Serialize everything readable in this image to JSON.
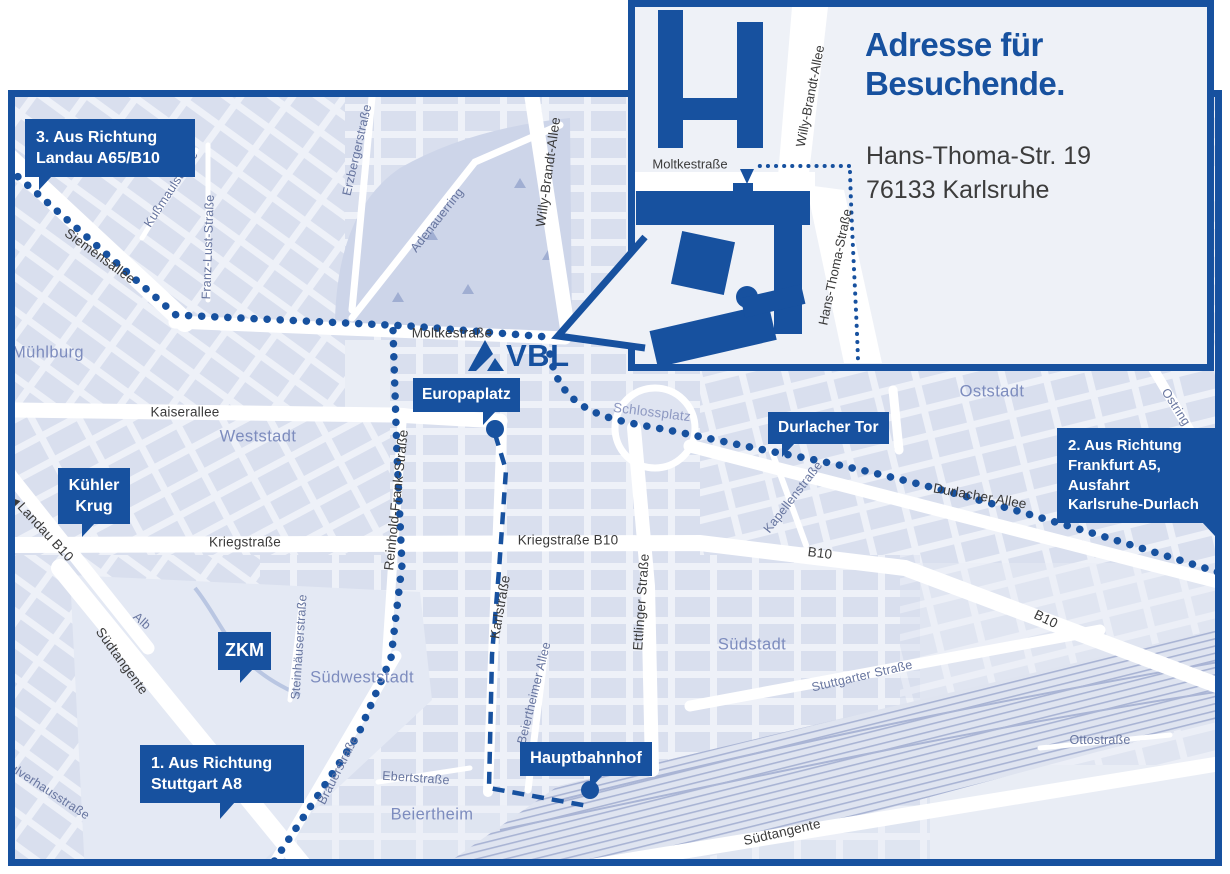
{
  "inset": {
    "title": "Adresse für\nBesuchende.",
    "address": "Hans-Thoma-Str. 19\n76133 Karlsruhe",
    "streets": {
      "moltkestrasse": "Moltkestraße",
      "willy_brandt_allee": "Willy-Brandt-Allee",
      "hans_thoma_strasse": "Hans-Thoma-Straße"
    }
  },
  "logo": {
    "text": "VBL"
  },
  "callouts": {
    "route3": "3. Aus Richtung\nLandau A65/B10",
    "route2": "2. Aus Richtung\nFrankfurt A5,\nAusfahrt\nKarlsruhe-Durlach",
    "route1": "1. Aus Richtung\nStuttgart A8",
    "europaplatz": "Europaplatz",
    "durlacher_tor": "Durlacher Tor",
    "kuehler_krug": "Kühler\nKrug",
    "zkm": "ZKM",
    "hauptbahnhof": "Hauptbahnhof"
  },
  "map": {
    "landau_arrow": "◀",
    "districts": {
      "muehlburg": "Mühlburg",
      "weststadt": "Weststadt",
      "oststadt": "Oststadt",
      "suedstadt": "Südstadt",
      "suedweststadt": "Südweststadt",
      "beiertheim": "Beiertheim",
      "schlossplatz": "Schlossplatz"
    },
    "streets": {
      "siemensallee": "Siemensallee",
      "kussmaulstrasse": "Kußmaulstraße",
      "franz_lust_strasse": "Franz-Lust-Straße",
      "erzbergerstrasse": "Erzbergerstraße",
      "adenauerring": "Adenauerring",
      "willy_brandt_allee": "Willy-Brandt-Allee",
      "moltkestrasse": "Moltkestraße",
      "kaiserallee": "Kaiserallee",
      "kriegstrasse": "Kriegstraße",
      "kriegstrasse_b10": "Kriegstraße B10",
      "reinhold_frank_strasse": "Reinhold-Frank-Straße",
      "karlstrasse": "Karlstraße",
      "ettlinger_strasse": "Ettlinger Straße",
      "durlacher_allee": "Durlacher Allee",
      "kapellenstrasse": "Kapellenstraße",
      "ostring": "Ostring",
      "b10_center": "B10",
      "b10_southeast": "B10",
      "landau_b10": "Landau B10",
      "suedtangente_west": "Südtangente",
      "suedtangente_southeast": "Südtangente",
      "alb": "Alb",
      "steinhaeuserstrasse": "Steinhäuserstraße",
      "brauerstrasse": "Brauerstraße",
      "ebertstrasse": "Ebertstraße",
      "beiertheimer_allee": "Beiertheimer Allee",
      "stuttgarter_strasse": "Stuttgarter Straße",
      "ottostrasse": "Ottostraße",
      "pulverhausstrasse": "Pulverhausstraße"
    }
  },
  "colors": {
    "brand_blue": "#17519f",
    "map_base": "#e9edf5",
    "block_fill": "#d9dfee",
    "park_fill": "#cdd5e9",
    "district_text": "#7d8cbe",
    "minor_street_text": "#67759f",
    "street_text": "#3a3a3a"
  }
}
